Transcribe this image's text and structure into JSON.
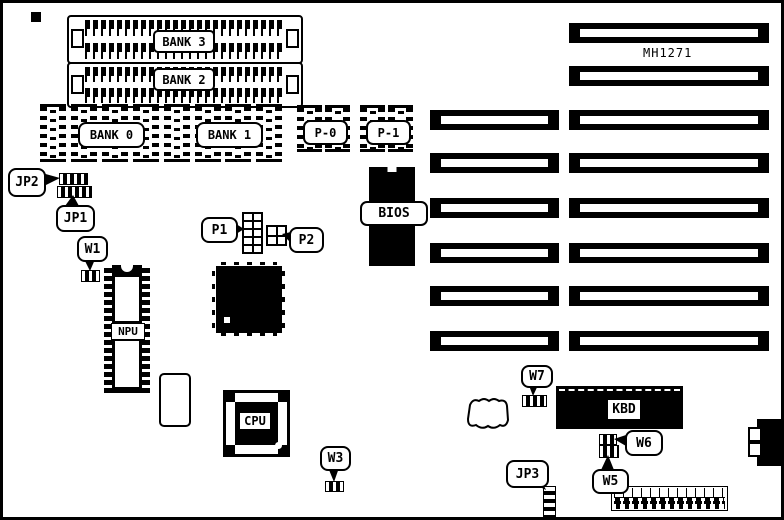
{
  "title": "MH1271",
  "labels": {
    "bank3": "BANK 3",
    "bank2": "BANK 2",
    "bank0": "BANK 0",
    "bank1": "BANK 1",
    "p0": "P-0",
    "p1": "P-1",
    "jp2": "JP2",
    "jp1": "JP1",
    "w1": "W1",
    "npu": "NPU",
    "p1hdr": "P1",
    "p2hdr": "P2",
    "bios": "BIOS",
    "cpu": "CPU",
    "w3": "W3",
    "w7": "W7",
    "kbd": "KBD",
    "w6": "W6",
    "w5": "W5",
    "jp3": "JP3"
  }
}
